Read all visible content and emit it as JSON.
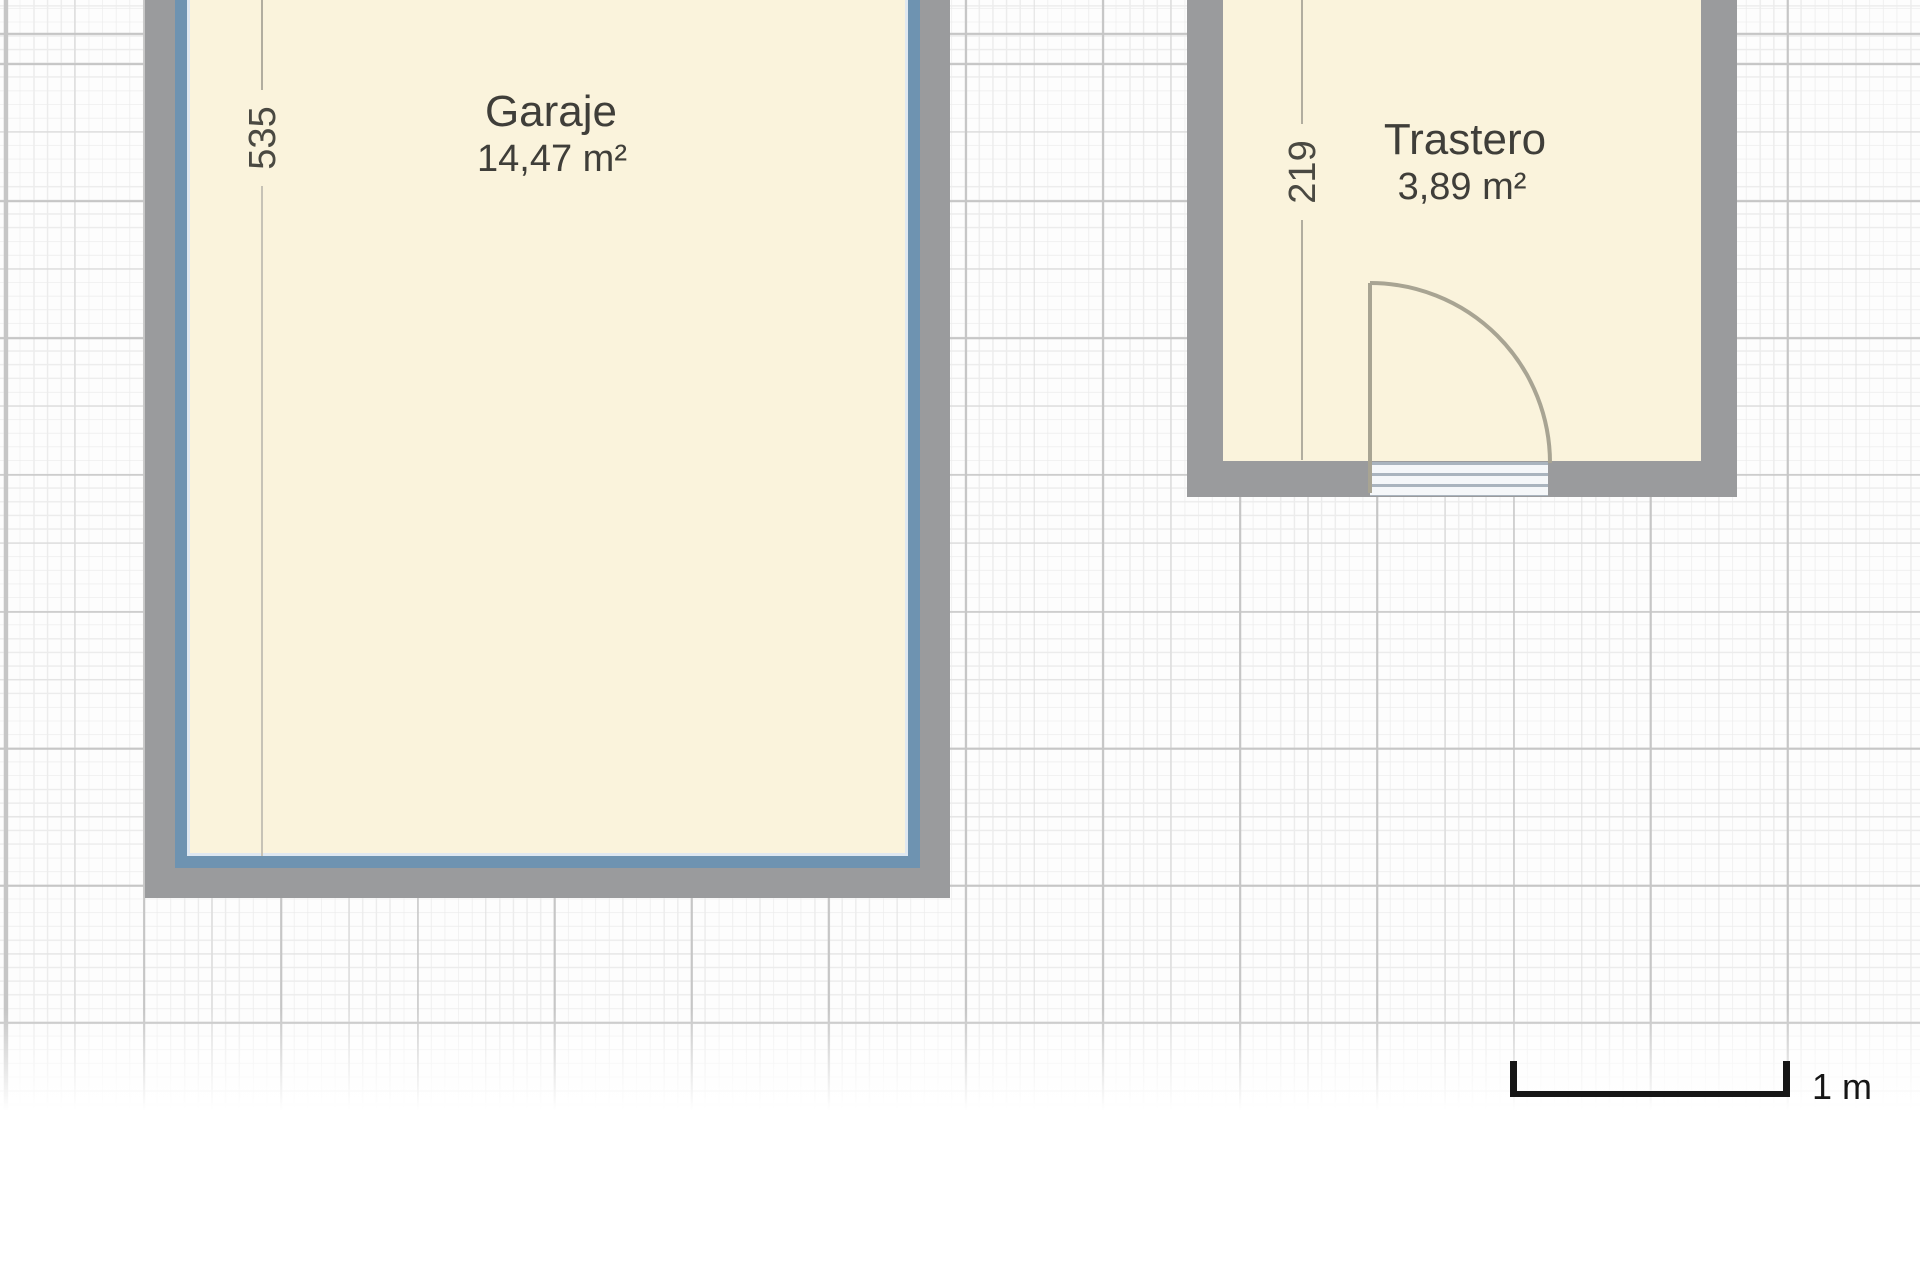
{
  "canvas": {
    "type": "floorplan-editor-canvas",
    "rooms": [
      {
        "name": "Garaje",
        "area_label": "14,47 m²",
        "dimension_label": "535",
        "selected": true
      },
      {
        "name": "Trastero",
        "area_label": "3,89 m²",
        "dimension_label": "219",
        "selected": false
      }
    ],
    "door": {
      "kind": "single-swing-door"
    },
    "scale_bar": {
      "label": "1 m"
    },
    "colors": {
      "floor_fill": "#faf3dc",
      "wall": "#9a9b9d",
      "selection_outline": "#6e93b1",
      "grid_major": "#c6c6c6",
      "grid_medium": "#dcdcdc",
      "grid_fine": "#ececec",
      "dimension_line": "#b1ad9f",
      "label_text": "#3f3e39",
      "scale_bar": "#161616"
    }
  }
}
